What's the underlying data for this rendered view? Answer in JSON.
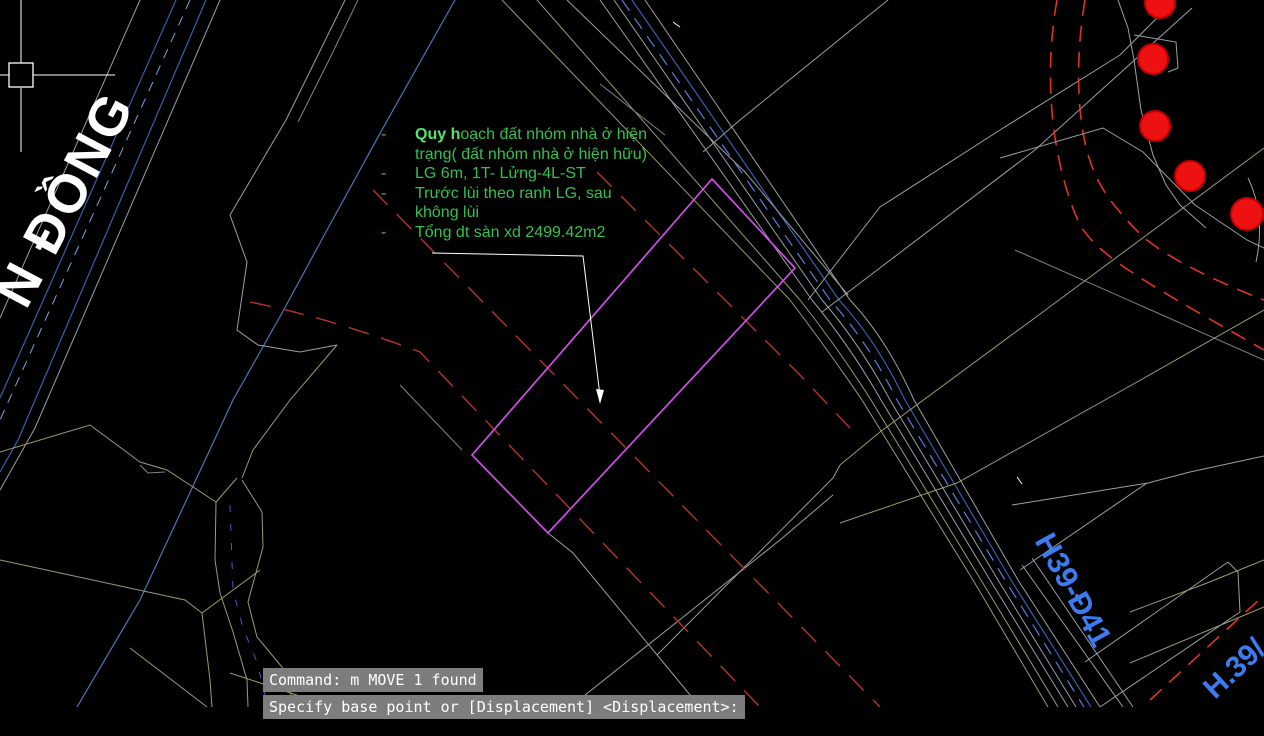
{
  "annotation": {
    "bullet": "-",
    "lines": [
      {
        "bold": "Quy h",
        "text": "oạch đất nhóm nhà ở hiện"
      },
      {
        "text": "trạng( đất nhóm nhà ở hiện hữu)"
      },
      {
        "text": "LG 6m, 1T- Lửng-4L-ST"
      },
      {
        "text": "Trước lùi theo ranh LG, sau"
      },
      {
        "text": "không lùi"
      },
      {
        "text": "Tổng dt sàn xd 2499.42m2"
      }
    ]
  },
  "labels": {
    "street_main": "N ĐỒNG",
    "road_label_1": "H39-Đ41",
    "road_label_2": "H.39/"
  },
  "command_bar": {
    "line1": "Command: m MOVE 1 found",
    "line2": "Specify base point or [Displacement] <Displacement>:"
  },
  "colors": {
    "bg": "#000000",
    "gray": "#9aa0a4",
    "gray2": "#7e8488",
    "khaki": "#9c9c6e",
    "blue": "#3a5fb0",
    "steel": "#4a78b8",
    "bluedash": "#5b7fe0",
    "cyandash": "#76a8dc",
    "navydash": "#3f5fc0",
    "red": "#b5342c",
    "redbright": "#e03227",
    "magenta": "#cf4fe8",
    "green": "#35c04f",
    "greenbold": "#58e46e",
    "labelblue": "#3d7bf0",
    "treefill": "#ee1111",
    "treestroke": "#c00000",
    "cmdbg": "#7d7d7d"
  }
}
